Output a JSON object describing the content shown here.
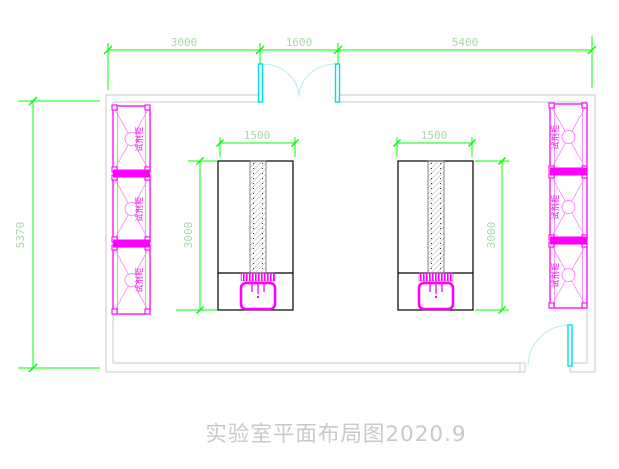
{
  "drawing": {
    "title": "实验室平面布局图2020.9"
  },
  "dimensions": {
    "top_segment_1": "3000",
    "top_segment_2": "1600",
    "top_segment_3": "5400",
    "room_height": "5370",
    "bench_width": "1500",
    "bench_depth": "3000"
  },
  "labels": {
    "reagent_cabinet": "试剂柜"
  },
  "colors": {
    "dimension_green": "#00ff00",
    "dimension_text_green": "#a8d8a8",
    "cad_magenta": "#ff00ff",
    "door_cyan": "#00dede",
    "wall_gray": "#c9c9c9",
    "bench_black": "#000000",
    "title_gray": "#c9c9c9"
  }
}
